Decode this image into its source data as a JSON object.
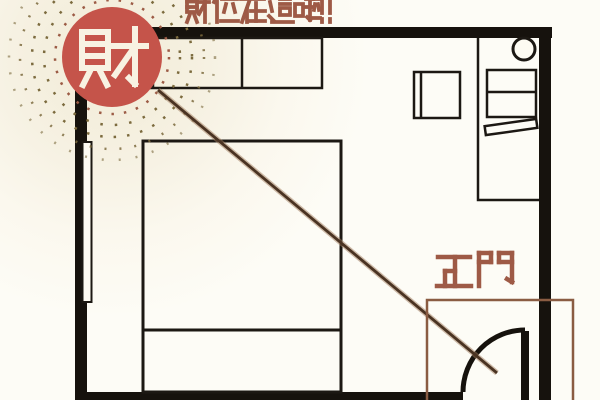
{
  "banner": {
    "text": "財位在這啦!!",
    "color": "#9e5a46"
  },
  "wealth_badge": {
    "char": "財",
    "circle_color": "#c5544a",
    "glyph_color": "#f8f2e2"
  },
  "door": {
    "label": "正門",
    "label_color": "#9e5a46",
    "highlight_color": "#8a5c42"
  },
  "sight_line": {
    "core_color": "#4a3322",
    "halo_color": "#a07c5e"
  },
  "palette": {
    "background": "#fbf8ee",
    "wall": "#16120d",
    "furniture_line": "#1c1813",
    "furniture_fill": "#fdfbf2",
    "radiance_dashes": "#7c6b3e",
    "radiance_accent": "#9c5b45"
  },
  "floorplan": {
    "furniture": [
      "wardrobe",
      "window",
      "bed",
      "desk-nook-partition",
      "stool",
      "desk",
      "keyboard",
      "desk-chair",
      "entry-door",
      "door-swing-arc"
    ]
  }
}
